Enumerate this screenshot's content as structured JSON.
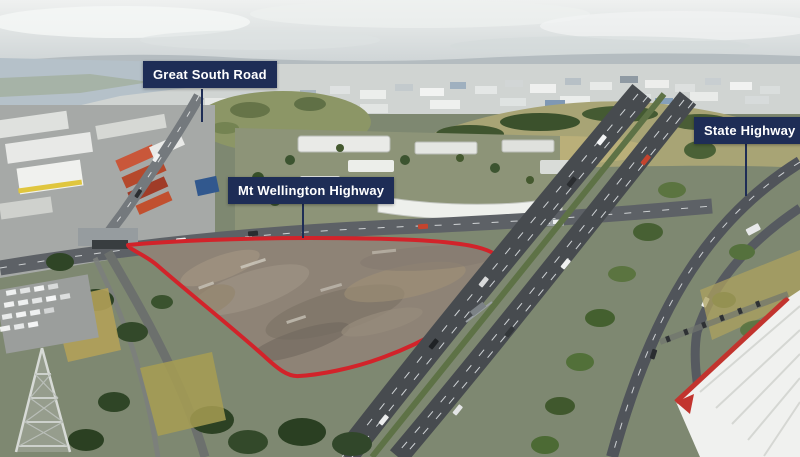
{
  "image": {
    "type": "annotated-aerial-photo",
    "colors": {
      "label_bg": "#1e2d56",
      "label_text": "#ffffff",
      "boundary": "#d2232a"
    }
  },
  "labels": {
    "great_south_road": "Great South Road",
    "mt_wellington_highway": "Mt Wellington Highway",
    "state_highway_1": "State Highway 1"
  }
}
